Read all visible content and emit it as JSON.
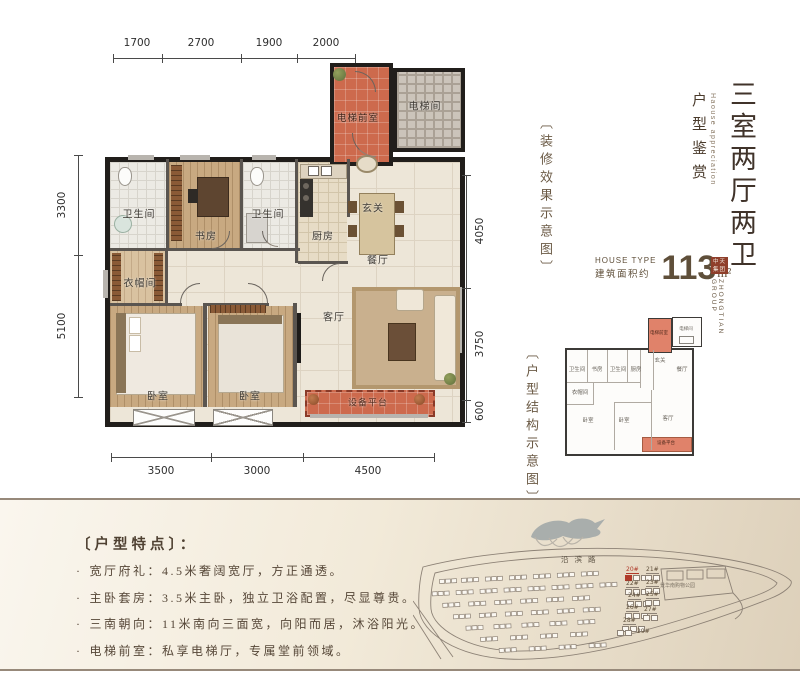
{
  "title": {
    "main_vertical": "三室两厅两卫",
    "sub": "户型鉴赏",
    "sub_en": "Haouse appreciation"
  },
  "captions": {
    "render": "〔装修效果示意图〕",
    "structure": "〔户型结构示意图〕"
  },
  "area": {
    "house_type_en": "HOUSE TYPE",
    "label": "建筑面积约",
    "value": "113",
    "unit": "m²"
  },
  "brand": {
    "seal": "中天集团",
    "group_en": "ZHONGTIAN GROUP"
  },
  "floorplan": {
    "rooms": {
      "lobby": "电梯前室",
      "elevator": "电梯间",
      "bath1": "卫生间",
      "study": "书房",
      "bath2": "卫生间",
      "kitchen": "厨房",
      "entry": "玄关",
      "dining": "餐厅",
      "cloak": "衣帽间",
      "bedroom1": "卧室",
      "bedroom2": "卧室",
      "living": "客厅",
      "platform": "设备平台"
    },
    "dims": {
      "top": [
        "1700",
        "2700",
        "1900",
        "2000"
      ],
      "left": [
        "3300",
        "5100"
      ],
      "right": [
        "4050",
        "3750",
        "600"
      ],
      "bottom": [
        "3500",
        "3000",
        "4500"
      ]
    }
  },
  "features": {
    "heading": "〔户型特点〕：",
    "items": [
      "宽厅府礼：4.5米奢阔宽厅，方正通透。",
      "主卧套房：3.5米主卧，独立卫浴配置，尽显尊贵。",
      "三南朝向：11米南向三面宽，向阳而居，沐浴阳光。",
      "电梯前室：私享电梯厅，专属堂前领域。"
    ]
  },
  "sitemap": {
    "road": "沿滨路",
    "park": "景华南购物公园",
    "buildings": [
      "20#",
      "21#",
      "22#",
      "23#",
      "24#",
      "25#",
      "26#",
      "27#",
      "28#",
      "29#"
    ],
    "highlighted": "20#"
  },
  "colors": {
    "accent_orange": "#cd6a4d",
    "brown_text": "#5f4f3a",
    "highlight_red": "#b03a2a",
    "band_line": "#97897a"
  }
}
